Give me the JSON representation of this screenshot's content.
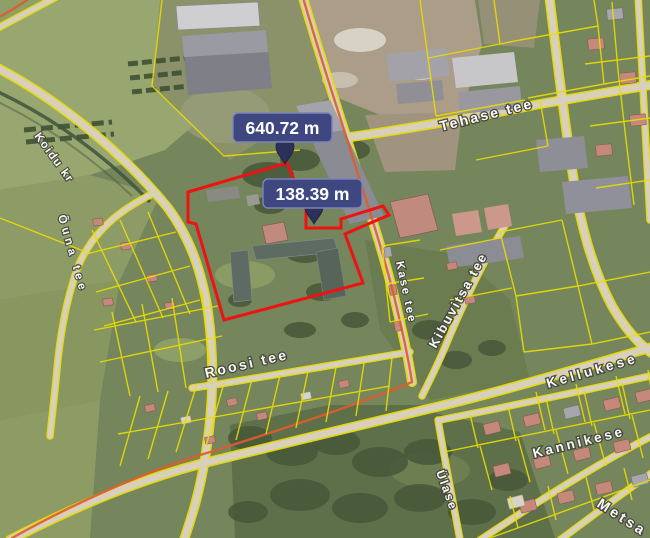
{
  "map_type": "satellite",
  "measurements": [
    {
      "text": "640.72 m"
    },
    {
      "text": "138.39 m"
    }
  ],
  "streets": [
    {
      "name": "Koidu kr"
    },
    {
      "name": "Õuna tee"
    },
    {
      "name": "Tehase tee"
    },
    {
      "name": "Kibuvitsa tee"
    },
    {
      "name": "Kase tee"
    },
    {
      "name": "Roosi tee"
    },
    {
      "name": "Kellukese"
    },
    {
      "name": "Kannikese"
    },
    {
      "name": "Ülase"
    },
    {
      "name": "Metsa"
    }
  ],
  "colors": {
    "parcel_boundary": "#e9dd00",
    "selected_parcel": "#ee1212",
    "road_accent": "#dd5c2b",
    "measure_badge_bg": "#3f4780",
    "measure_badge_border": "#7b84b8",
    "measure_text": "#ffffff",
    "street_label_text": "#ffffff",
    "street_label_halo": "#45463c"
  }
}
